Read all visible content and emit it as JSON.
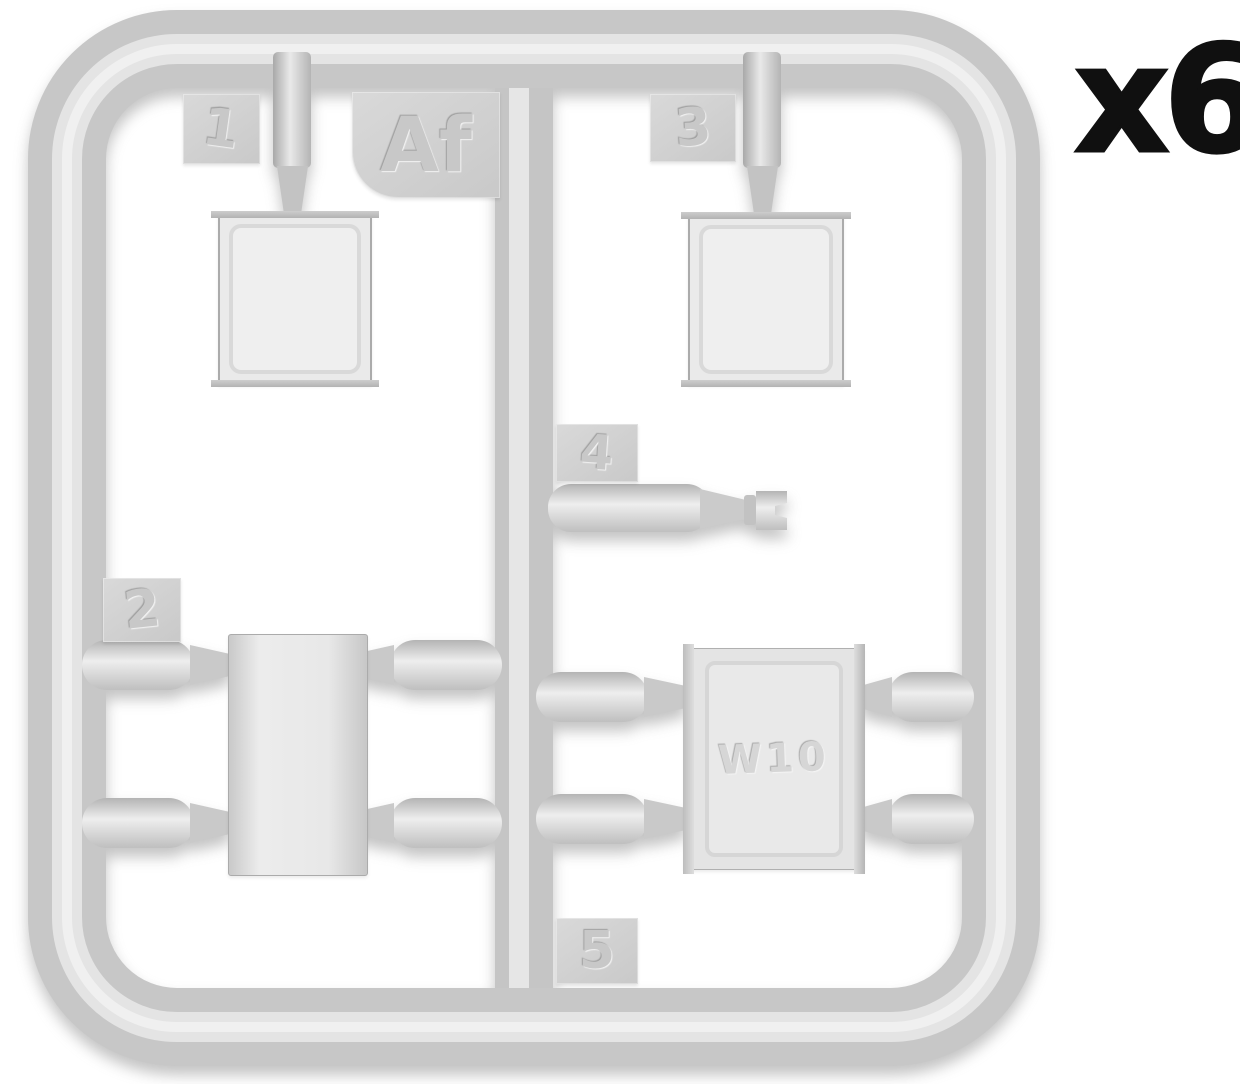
{
  "diagram": {
    "quantity": "x6",
    "sprue_letter": "Af",
    "plate_marking": "W10",
    "parts": {
      "p1": "1",
      "p2": "2",
      "p3": "3",
      "p4": "4",
      "p5": "5"
    },
    "colors": {
      "plastic_base": "#cccccc",
      "plastic_highlight": "#ebebeb",
      "plastic_shadow": "#b0b0b0",
      "background": "#ffffff",
      "quantity_text": "#111111"
    }
  }
}
